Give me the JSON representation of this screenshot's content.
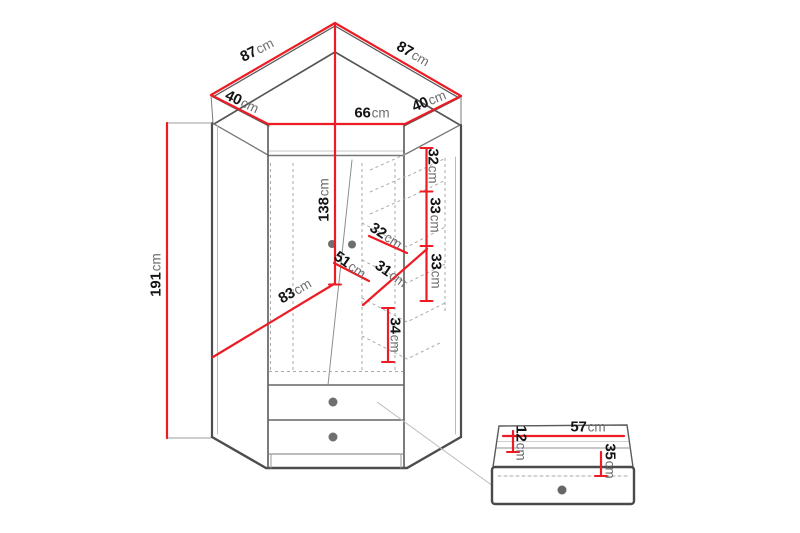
{
  "colors": {
    "dimension": "#ed1c24",
    "outline": "#4d4d4d",
    "line_light": "#8a8a8a",
    "dashed": "#a9a9a9",
    "handle": "#6f6f6f",
    "value_text": "#141414",
    "unit_text": "#6e6e6e",
    "background": "#ffffff"
  },
  "labels": [
    {
      "name": "top-left-edge-width",
      "value": "87",
      "unit": "cm"
    },
    {
      "name": "top-right-edge-width",
      "value": "87",
      "unit": "cm"
    },
    {
      "name": "left-angled-edge",
      "value": "40",
      "unit": "cm"
    },
    {
      "name": "right-angled-edge",
      "value": "40",
      "unit": "cm"
    },
    {
      "name": "front-width",
      "value": "66",
      "unit": "cm"
    },
    {
      "name": "interior-height",
      "value": "138",
      "unit": "cm"
    },
    {
      "name": "right-shelf-gap-1",
      "value": "32",
      "unit": "cm"
    },
    {
      "name": "right-shelf-gap-2",
      "value": "33",
      "unit": "cm"
    },
    {
      "name": "right-shelf-gap-3",
      "value": "33",
      "unit": "cm"
    },
    {
      "name": "shelf-depth",
      "value": "32",
      "unit": "cm"
    },
    {
      "name": "door-width",
      "value": "51",
      "unit": "cm"
    },
    {
      "name": "shelf-width",
      "value": "31",
      "unit": "cm"
    },
    {
      "name": "interior-diagonal",
      "value": "83",
      "unit": "cm"
    },
    {
      "name": "lower-shelf-gap",
      "value": "34",
      "unit": "cm"
    },
    {
      "name": "total-height",
      "value": "191",
      "unit": "cm"
    },
    {
      "name": "drawer-width",
      "value": "57",
      "unit": "cm"
    },
    {
      "name": "drawer-top-depth",
      "value": "12",
      "unit": "cm"
    },
    {
      "name": "drawer-front-height",
      "value": "35",
      "unit": "cm"
    }
  ]
}
